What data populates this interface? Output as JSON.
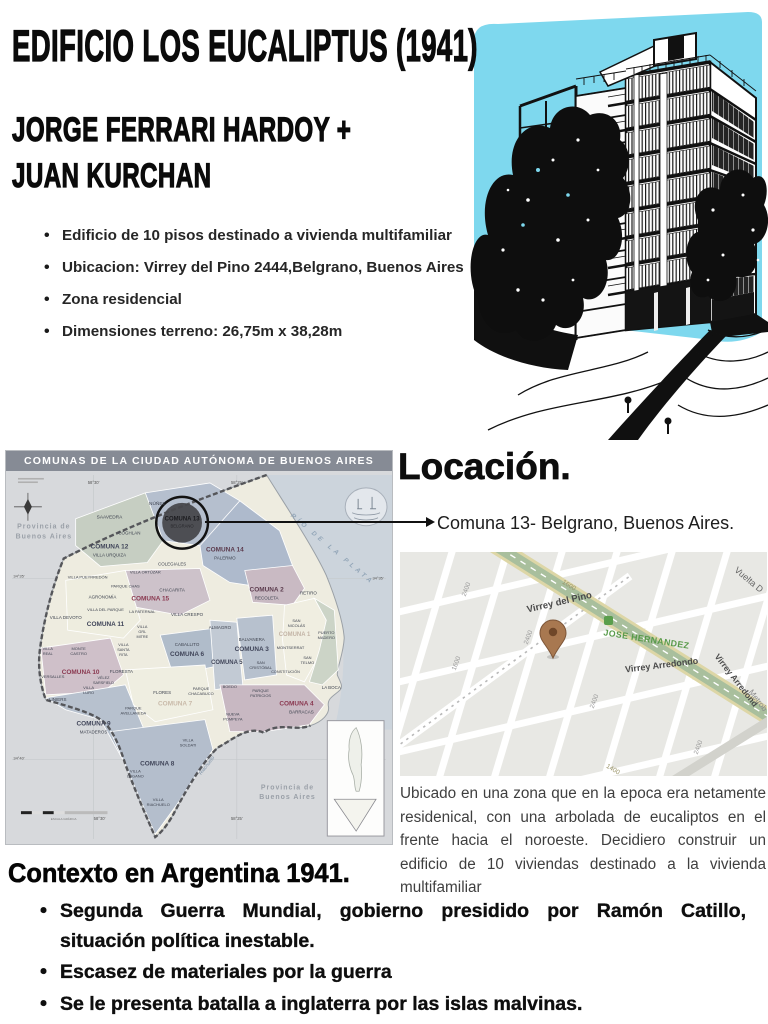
{
  "header": {
    "title": "EDIFICIO LOS EUCALIPTUS (1941)",
    "authors": [
      "JORGE FERRARI HARDOY +",
      "JUAN KURCHAN"
    ],
    "bullets": [
      "Edificio de 10 pisos destinado a vivienda multifamiliar",
      "Ubicacion: Virrey del Pino 2444,Belgrano, Buenos Aires",
      "Zona residencial",
      "Dimensiones terreno: 26,75m x 38,28m"
    ]
  },
  "illustration": {
    "description": "ink-drawing-of-10-story-building-with-eucalyptus-trees",
    "sky_color": "#7ed8ee"
  },
  "map": {
    "title": "COMUNAS DE LA CIUDAD AUTÓNOMA DE BUENOS AIRES",
    "header_bg": "#868b95",
    "labels": [
      {
        "t": "NÚÑEZ",
        "x": 152,
        "y": 34,
        "s": 4.8
      },
      {
        "t": "SAAVEDRA",
        "x": 104,
        "y": 48,
        "s": 4.8
      },
      {
        "t": "COMUNA 13",
        "x": 177,
        "y": 50,
        "s": 6,
        "b": 1,
        "c": "#1b1b1f"
      },
      {
        "t": "BELGRANO",
        "x": 177,
        "y": 57,
        "s": 4.2,
        "c": "#26262a"
      },
      {
        "t": "COGHLAN",
        "x": 124,
        "y": 64,
        "s": 4.5
      },
      {
        "t": "COMUNA 12",
        "x": 104,
        "y": 78,
        "s": 6.5,
        "b": 1,
        "c": "#41465a"
      },
      {
        "t": "VILLA URQUIZA",
        "x": 104,
        "y": 86,
        "s": 4.5
      },
      {
        "t": "COMUNA 14",
        "x": 220,
        "y": 81,
        "s": 6.5,
        "b": 1,
        "c": "#5c3c4e"
      },
      {
        "t": "PALERMO",
        "x": 220,
        "y": 89,
        "s": 4.5
      },
      {
        "t": "COLEGIALES",
        "x": 167,
        "y": 95,
        "s": 4.5
      },
      {
        "t": "Provincia de",
        "x": 38,
        "y": 58,
        "s": 7,
        "b": 1,
        "c": "#9aa0a8",
        "ls": 1
      },
      {
        "t": "Buenos Aires",
        "x": 38,
        "y": 68,
        "s": 7,
        "b": 1,
        "c": "#9aa0a8",
        "ls": 1
      },
      {
        "t": "VILLA PUEYRREDÓN",
        "x": 82,
        "y": 108,
        "s": 4
      },
      {
        "t": "VILLA ORTÚZAR",
        "x": 140,
        "y": 103,
        "s": 4
      },
      {
        "t": "PARQUE CHAS",
        "x": 120,
        "y": 117,
        "s": 4
      },
      {
        "t": "CHACARITA",
        "x": 167,
        "y": 121,
        "s": 4.5
      },
      {
        "t": "AGRONOMÍA",
        "x": 97,
        "y": 128,
        "s": 4.5
      },
      {
        "t": "COMUNA 15",
        "x": 145,
        "y": 130,
        "s": 6.5,
        "b": 1,
        "c": "#8a3850"
      },
      {
        "t": "COMUNA 2",
        "x": 262,
        "y": 121,
        "s": 6.5,
        "b": 1,
        "c": "#5c3c4e"
      },
      {
        "t": "RECOLETA",
        "x": 262,
        "y": 129,
        "s": 4.5
      },
      {
        "t": "RETIRO",
        "x": 304,
        "y": 124,
        "s": 4.5
      },
      {
        "t": "VILLA DEVOTO",
        "x": 60,
        "y": 149,
        "s": 4.5
      },
      {
        "t": "VILLA DEL PARQUE",
        "x": 100,
        "y": 141,
        "s": 4
      },
      {
        "t": "LA PATERNAL",
        "x": 137,
        "y": 143,
        "s": 4
      },
      {
        "t": "VILLA CRESPO",
        "x": 182,
        "y": 146,
        "s": 4.5
      },
      {
        "t": "COMUNA 11",
        "x": 100,
        "y": 156,
        "s": 6.5,
        "b": 1,
        "c": "#41465a"
      },
      {
        "t": "VILLA",
        "x": 137,
        "y": 158,
        "s": 3.8
      },
      {
        "t": "GRL",
        "x": 137,
        "y": 163,
        "s": 3.8
      },
      {
        "t": "MITRE",
        "x": 137,
        "y": 168,
        "s": 3.8
      },
      {
        "t": "ALMAGRO",
        "x": 215,
        "y": 159,
        "s": 4.5
      },
      {
        "t": "SAN",
        "x": 292,
        "y": 152,
        "s": 4
      },
      {
        "t": "NICOLÁS",
        "x": 292,
        "y": 157,
        "s": 4
      },
      {
        "t": "BALVANERA",
        "x": 247,
        "y": 171,
        "s": 4.5
      },
      {
        "t": "COMUNA 1",
        "x": 290,
        "y": 166,
        "s": 6,
        "b": 1,
        "c": "#c3b4a6"
      },
      {
        "t": "PUERTO",
        "x": 322,
        "y": 164,
        "s": 4
      },
      {
        "t": "MADERO",
        "x": 322,
        "y": 169,
        "s": 4
      },
      {
        "t": "CABALLITO",
        "x": 182,
        "y": 176,
        "s": 4.5
      },
      {
        "t": "COMUNA 6",
        "x": 182,
        "y": 186,
        "s": 6.5,
        "b": 1,
        "c": "#41465a"
      },
      {
        "t": "COMUNA 3",
        "x": 247,
        "y": 181,
        "s": 6.5,
        "b": 1,
        "c": "#41465a"
      },
      {
        "t": "MONTSERRAT",
        "x": 286,
        "y": 179,
        "s": 4
      },
      {
        "t": "VILLA",
        "x": 118,
        "y": 176,
        "s": 3.8
      },
      {
        "t": "SANTA",
        "x": 118,
        "y": 181,
        "s": 3.8
      },
      {
        "t": "RITA",
        "x": 118,
        "y": 186,
        "s": 3.8
      },
      {
        "t": "MONTE",
        "x": 73,
        "y": 180,
        "s": 4
      },
      {
        "t": "CASTRO",
        "x": 73,
        "y": 185,
        "s": 4
      },
      {
        "t": "VILLA",
        "x": 42,
        "y": 180,
        "s": 3.8
      },
      {
        "t": "REAL",
        "x": 42,
        "y": 185,
        "s": 3.8
      },
      {
        "t": "COMUNA 5",
        "x": 222,
        "y": 194,
        "s": 6,
        "b": 1,
        "c": "#41465a"
      },
      {
        "t": "SAN",
        "x": 256,
        "y": 194,
        "s": 4
      },
      {
        "t": "CRISTÓBAL",
        "x": 256,
        "y": 199,
        "s": 4
      },
      {
        "t": "SAN",
        "x": 303,
        "y": 189,
        "s": 4
      },
      {
        "t": "TELMO",
        "x": 303,
        "y": 194,
        "s": 4
      },
      {
        "t": "CONSTITUCIÓN",
        "x": 281,
        "y": 203,
        "s": 3.8
      },
      {
        "t": "COMUNA 10",
        "x": 75,
        "y": 204,
        "s": 6.5,
        "b": 1,
        "c": "#8a3850"
      },
      {
        "t": "FLORESTA",
        "x": 116,
        "y": 203,
        "s": 4.5
      },
      {
        "t": "VÉLEZ",
        "x": 98,
        "y": 209,
        "s": 3.8
      },
      {
        "t": "SARSFIELD",
        "x": 98,
        "y": 214,
        "s": 3.8
      },
      {
        "t": "VERSALLES",
        "x": 47,
        "y": 208,
        "s": 4
      },
      {
        "t": "BOEDO",
        "x": 225,
        "y": 218,
        "s": 4
      },
      {
        "t": "VILLA",
        "x": 83,
        "y": 219,
        "s": 4
      },
      {
        "t": "LURO",
        "x": 83,
        "y": 224,
        "s": 4
      },
      {
        "t": "FLORES",
        "x": 157,
        "y": 224,
        "s": 4.5
      },
      {
        "t": "PARQUE",
        "x": 196,
        "y": 220,
        "s": 4
      },
      {
        "t": "CHACABUCO",
        "x": 196,
        "y": 225,
        "s": 4
      },
      {
        "t": "PARQUE",
        "x": 256,
        "y": 222,
        "s": 4
      },
      {
        "t": "PATRICIOS",
        "x": 256,
        "y": 227,
        "s": 4
      },
      {
        "t": "LA BOCA",
        "x": 327,
        "y": 219,
        "s": 4.5
      },
      {
        "t": "COMUNA 7",
        "x": 170,
        "y": 236,
        "s": 6.5,
        "b": 1,
        "c": "#c9baa9"
      },
      {
        "t": "COMUNA 4",
        "x": 292,
        "y": 236,
        "s": 6.5,
        "b": 1,
        "c": "#8a3850"
      },
      {
        "t": "BARRACAS",
        "x": 297,
        "y": 244,
        "s": 4.5
      },
      {
        "t": "LINIERS",
        "x": 52,
        "y": 231,
        "s": 4.5
      },
      {
        "t": "PARQUE",
        "x": 128,
        "y": 240,
        "s": 4
      },
      {
        "t": "AVELLANEDA",
        "x": 128,
        "y": 245,
        "s": 4
      },
      {
        "t": "NUEVA",
        "x": 228,
        "y": 246,
        "s": 4
      },
      {
        "t": "POMPEYA",
        "x": 228,
        "y": 251,
        "s": 4
      },
      {
        "t": "COMUNA 9",
        "x": 88,
        "y": 256,
        "s": 6.5,
        "b": 1,
        "c": "#41465a"
      },
      {
        "t": "MATADEROS",
        "x": 88,
        "y": 264,
        "s": 4.5
      },
      {
        "t": "VILLA",
        "x": 183,
        "y": 272,
        "s": 4
      },
      {
        "t": "SOLDATI",
        "x": 183,
        "y": 277,
        "s": 4
      },
      {
        "t": "COMUNA 8",
        "x": 152,
        "y": 296,
        "s": 6.5,
        "b": 1,
        "c": "#41465a"
      },
      {
        "t": "VILLA",
        "x": 130,
        "y": 303,
        "s": 4
      },
      {
        "t": "LUGANO",
        "x": 130,
        "y": 308,
        "s": 4
      },
      {
        "t": "Riachuelo",
        "x": 203,
        "y": 297,
        "s": 5,
        "c": "#7f93a8",
        "r": -52,
        "i": 1
      },
      {
        "t": "Provincia de",
        "x": 283,
        "y": 320,
        "s": 7,
        "b": 1,
        "c": "#9aa0a8",
        "ls": 1
      },
      {
        "t": "Buenos Aires",
        "x": 283,
        "y": 330,
        "s": 7,
        "b": 1,
        "c": "#9aa0a8",
        "ls": 1
      },
      {
        "t": "VILLA",
        "x": 153,
        "y": 332,
        "s": 4
      },
      {
        "t": "RIACHUELO",
        "x": 153,
        "y": 337,
        "s": 4
      },
      {
        "t": "58°30'",
        "x": 88,
        "y": 13,
        "s": 4.2,
        "c": "#555"
      },
      {
        "t": "58°25'",
        "x": 232,
        "y": 13,
        "s": 4.2,
        "c": "#555"
      },
      {
        "t": "34°35'",
        "x": 13,
        "y": 107,
        "s": 4,
        "c": "#555"
      },
      {
        "t": "34°35'",
        "x": 374,
        "y": 109,
        "s": 4,
        "c": "#555"
      },
      {
        "t": "34°40'",
        "x": 13,
        "y": 290,
        "s": 4,
        "c": "#555"
      },
      {
        "t": "58°30'",
        "x": 94,
        "y": 351,
        "s": 4.2,
        "c": "#555"
      },
      {
        "t": "58°25'",
        "x": 232,
        "y": 351,
        "s": 4.2,
        "c": "#555"
      },
      {
        "t": "RÍO DE LA PLATA",
        "x": 327,
        "y": 80,
        "s": 6.5,
        "c": "#93a6b8",
        "r": 40,
        "ls": 3.5,
        "i": 1,
        "b": 1
      },
      {
        "t": "ESCALA GRÁFICA",
        "x": 58,
        "y": 351,
        "s": 3,
        "c": "#777"
      }
    ]
  },
  "location": {
    "heading": "Locación.",
    "callout": "Comuna 13- Belgrano, Buenos Aires.",
    "description": "Ubicado en una zona que en la epoca era netamente residenical, con una arbolada de eucaliptos en el frente hacia el noroeste. Decidiero construir un edificio de 10 viviendas destinado a la vivienda multifamiliar"
  },
  "streetmap": {
    "pin_color": "#a87850",
    "labels": [
      {
        "t": "Virrey del Pino",
        "x": 160,
        "y": 53,
        "s": 9.5,
        "c": "#4a4a4a",
        "b": 1,
        "r": -13
      },
      {
        "t": "JOSE HERNANDEZ",
        "x": 246,
        "y": 90,
        "s": 8.8,
        "c": "#589a49",
        "b": 1,
        "r": 9,
        "ls": 0.4
      },
      {
        "t": "Virrey Arredondo",
        "x": 262,
        "y": 116,
        "s": 9,
        "c": "#4a4a4a",
        "b": 1,
        "r": -7
      },
      {
        "t": "Vuelta D",
        "x": 347,
        "y": 30,
        "s": 9,
        "c": "#666666",
        "r": 40
      },
      {
        "t": "Virrey Arredond",
        "x": 334,
        "y": 130,
        "s": 8.5,
        "c": "#4a4a4a",
        "b": 1,
        "r": 52
      },
      {
        "t": "Metrob",
        "x": 356,
        "y": 150,
        "s": 8,
        "c": "#888888",
        "r": 52
      },
      {
        "t": "2400",
        "x": 130,
        "y": 86,
        "s": 6.5,
        "c": "#999999",
        "r": -70
      },
      {
        "t": "1600",
        "x": 58,
        "y": 112,
        "s": 6.5,
        "c": "#999999",
        "r": -70
      },
      {
        "t": "2400",
        "x": 68,
        "y": 38,
        "s": 6.5,
        "c": "#999999",
        "r": -70
      },
      {
        "t": "1600",
        "x": 168,
        "y": 35,
        "s": 6.5,
        "c": "#9a9468",
        "r": 31
      },
      {
        "t": "2400",
        "x": 196,
        "y": 150,
        "s": 6.5,
        "c": "#999999",
        "r": -70
      },
      {
        "t": "2400",
        "x": 300,
        "y": 196,
        "s": 6.5,
        "c": "#999999",
        "r": -70
      },
      {
        "t": "1400",
        "x": 212,
        "y": 219,
        "s": 6.5,
        "c": "#9a9468",
        "r": 31
      }
    ]
  },
  "context": {
    "heading": "Contexto en Argentina 1941.",
    "bullets": [
      "Segunda Guerra Mundial, gobierno presidido por Ramón Catillo, situación política inestable.",
      "Escasez de materiales por la guerra",
      "Se le presenta batalla a inglaterra por las islas malvinas.",
      "Plan de Buenos Aires contemplaba a Belgrano como “Núcleo Satélite”"
    ]
  }
}
